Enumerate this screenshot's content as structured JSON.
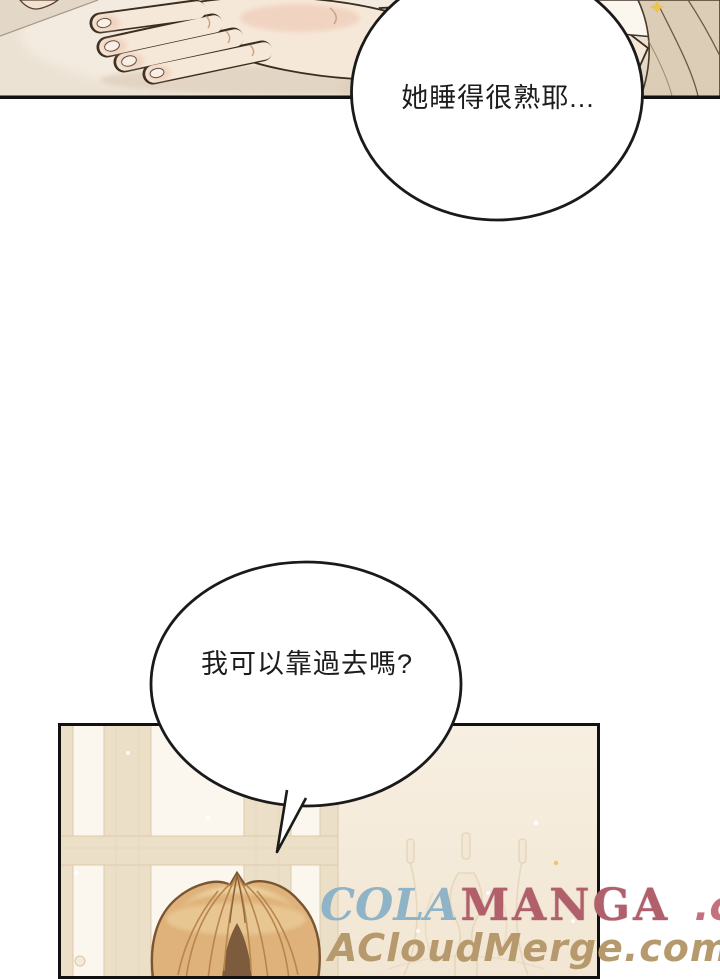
{
  "page": {
    "width": 720,
    "height": 979,
    "background": "#ffffff",
    "type": "manga page"
  },
  "panels": {
    "top_panel": {
      "description": "close-up of a hand resting on pale bedding, sleeve at right",
      "background": "#ece2d3",
      "border_color": "#111111"
    },
    "bottom_panel": {
      "description": "room with cream window and faint wall sconce, blonde character entering from bottom",
      "background": "#f6eedd",
      "border_color": "#111111"
    }
  },
  "speech_bubbles": [
    {
      "text": "她睡得很熟耶...",
      "fill": "#ffffff",
      "stroke": "#1a1a1a"
    },
    {
      "text": "我可以靠過去嗎?",
      "fill": "#ffffff",
      "stroke": "#1a1a1a"
    }
  ],
  "watermark": {
    "line1": {
      "cola": "COLA",
      "manga": "MANGA",
      "dotcom": ".com",
      "cola_color": "#8fb4c7",
      "manga_color": "#b25f6c",
      "dotcom_color": "#c4707d"
    },
    "line2": {
      "text": "ACloudMerge.com",
      "color": "#b69a6d"
    }
  },
  "art_colors": {
    "skin": "#f6e8d8",
    "skin_shadow": "#ecc9b4",
    "nail": "#f8efe6",
    "sheet": "#ece2d3",
    "sheet_light": "#f4ece1",
    "sheet_shadow": "#d9c7b2",
    "pillow_corner": "#e3d8c7",
    "sleeve": "#dccdb7",
    "sleeve_line": "#6e5a44",
    "cuff": "#fbf6ee",
    "line_art": "#3b2d20",
    "wall": "#f4ebdc",
    "window_pane": "#fbf7ef",
    "mullion": "#ecdfc7",
    "mullion_edge": "#ddcbab",
    "sconce_line": "#ddc9a8",
    "hair": "#deb27a",
    "hair_highlight": "#f0d7a6",
    "hair_shadow": "#b9854e",
    "hair_outline": "#7a5531",
    "hair_gap_shadow": "#7c5c3c",
    "sparkle_gold": "#e9c457"
  }
}
